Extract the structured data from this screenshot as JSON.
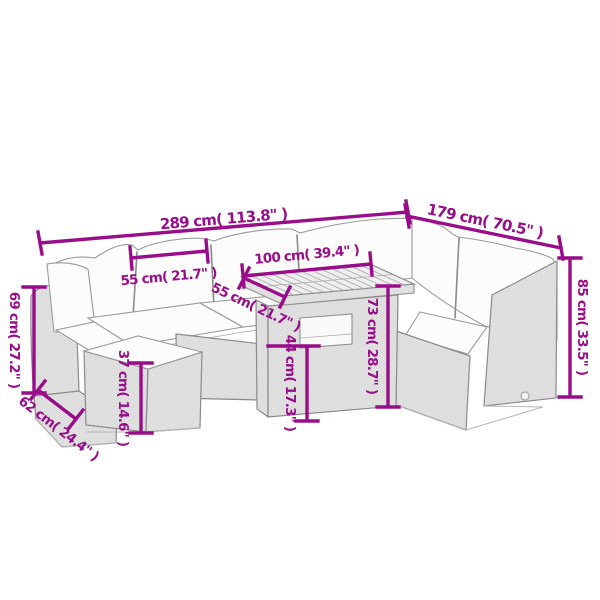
{
  "colors": {
    "dimension": "#990D8A",
    "background": "#ffffff",
    "drawing_outline": "#8f8f8f"
  },
  "dimensions": {
    "total_width": {
      "label": "289 cm( 113.8\" )"
    },
    "total_depth": {
      "label": "179 cm( 70.5\" )"
    },
    "seat_width": {
      "label": "55 cm( 21.7\" )"
    },
    "table_length": {
      "label": "100 cm( 39.4\" )"
    },
    "table_width": {
      "label": "55 cm( 21.7\" )"
    },
    "back_height": {
      "label": "69 cm( 27.2\" )"
    },
    "seat_depth": {
      "label": "62 cm( 24.4\" )"
    },
    "stool_height": {
      "label": "37 cm( 14.6\" )"
    },
    "table_lower_height": {
      "label": "44 cm( 17.3\" )"
    },
    "table_height": {
      "label": "73 cm( 28.7\" )"
    },
    "total_height": {
      "label": "85 cm( 33.5\" )"
    }
  }
}
